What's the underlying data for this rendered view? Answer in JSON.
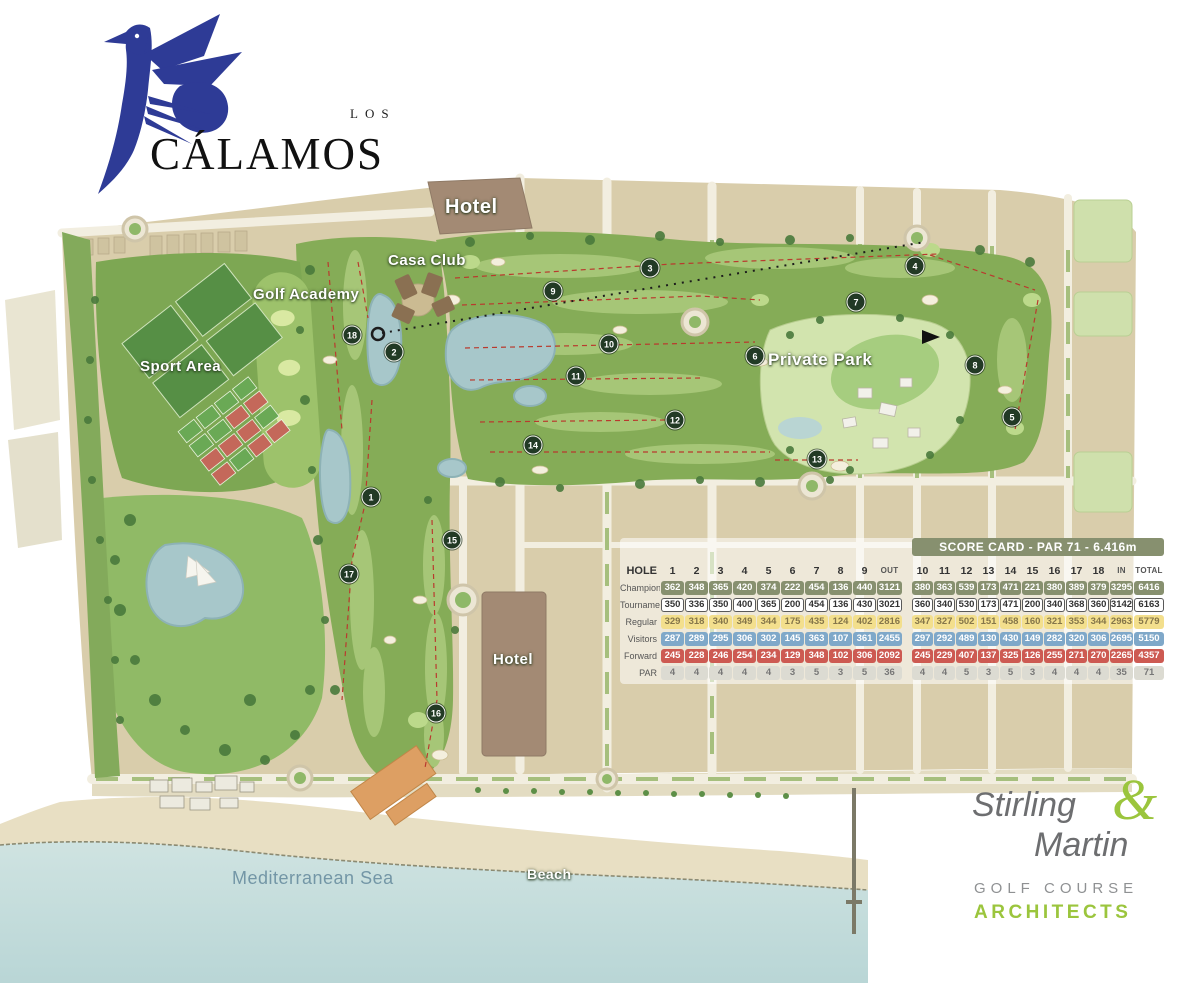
{
  "logo": {
    "pretitle": "LOS",
    "title": "CÁLAMOS"
  },
  "map": {
    "labels": {
      "hotel_north": "Hotel",
      "casa_club": "Casa Club",
      "golf_academy": "Golf Academy",
      "sport_area": "Sport Area",
      "private_park": "Private Park",
      "hotel_beach": "Hotel",
      "beach": "Beach",
      "sea": "Mediterranean Sea"
    },
    "holes": [
      {
        "n": "1",
        "x": 371,
        "y": 497
      },
      {
        "n": "2",
        "x": 394,
        "y": 352
      },
      {
        "n": "3",
        "x": 650,
        "y": 268
      },
      {
        "n": "4",
        "x": 915,
        "y": 266
      },
      {
        "n": "5",
        "x": 1012,
        "y": 417
      },
      {
        "n": "6",
        "x": 755,
        "y": 356
      },
      {
        "n": "7",
        "x": 856,
        "y": 302
      },
      {
        "n": "8",
        "x": 975,
        "y": 365
      },
      {
        "n": "9",
        "x": 553,
        "y": 291
      },
      {
        "n": "10",
        "x": 609,
        "y": 344
      },
      {
        "n": "11",
        "x": 576,
        "y": 376
      },
      {
        "n": "12",
        "x": 675,
        "y": 420
      },
      {
        "n": "13",
        "x": 817,
        "y": 459
      },
      {
        "n": "14",
        "x": 533,
        "y": 445
      },
      {
        "n": "15",
        "x": 452,
        "y": 540
      },
      {
        "n": "16",
        "x": 436,
        "y": 713
      },
      {
        "n": "17",
        "x": 349,
        "y": 574
      },
      {
        "n": "18",
        "x": 352,
        "y": 335
      }
    ]
  },
  "scorecard": {
    "title": "SCORE CARD - PAR 71 - 6.416m",
    "hole_header": "HOLE",
    "out_label": "OUT",
    "in_label": "IN",
    "total_label": "TOTAL",
    "front_holes": [
      "1",
      "2",
      "3",
      "4",
      "5",
      "6",
      "7",
      "8",
      "9"
    ],
    "back_holes": [
      "10",
      "11",
      "12",
      "13",
      "14",
      "15",
      "16",
      "17",
      "18"
    ],
    "rows": [
      {
        "label": "Champions",
        "style": "champions",
        "front": [
          362,
          348,
          365,
          420,
          374,
          222,
          454,
          136,
          440
        ],
        "out": 3121,
        "back": [
          380,
          363,
          539,
          173,
          471,
          221,
          380,
          389,
          379
        ],
        "in": 3295,
        "total": 6416
      },
      {
        "label": "Tournament",
        "style": "tournament",
        "front": [
          350,
          336,
          350,
          400,
          365,
          200,
          454,
          136,
          430
        ],
        "out": 3021,
        "back": [
          360,
          340,
          530,
          173,
          471,
          200,
          340,
          368,
          360
        ],
        "in": 3142,
        "total": 6163
      },
      {
        "label": "Regular",
        "style": "regular",
        "front": [
          329,
          318,
          340,
          349,
          344,
          175,
          435,
          124,
          402
        ],
        "out": 2816,
        "back": [
          347,
          327,
          502,
          151,
          458,
          160,
          321,
          353,
          344
        ],
        "in": 2963,
        "total": 5779
      },
      {
        "label": "Visitors",
        "style": "visitors",
        "front": [
          287,
          289,
          295,
          306,
          302,
          145,
          363,
          107,
          361
        ],
        "out": 2455,
        "back": [
          297,
          292,
          489,
          130,
          430,
          149,
          282,
          320,
          306
        ],
        "in": 2695,
        "total": 5150
      },
      {
        "label": "Forward",
        "style": "forward",
        "front": [
          245,
          228,
          246,
          254,
          234,
          129,
          348,
          102,
          306
        ],
        "out": 2092,
        "back": [
          245,
          229,
          407,
          137,
          325,
          126,
          255,
          271,
          270
        ],
        "in": 2265,
        "total": 4357
      },
      {
        "label": "PAR",
        "style": "par",
        "front": [
          4,
          4,
          4,
          4,
          4,
          3,
          5,
          3,
          5
        ],
        "out": 36,
        "back": [
          4,
          4,
          5,
          3,
          5,
          3,
          4,
          4,
          4
        ],
        "in": 35,
        "total": 71
      }
    ]
  },
  "architects": {
    "name1": "Stirling",
    "amp": "&",
    "name2": "Martin",
    "sub1": "GOLF COURSE",
    "sub2": "ARCHITECTS"
  },
  "colors": {
    "logo_navy": "#2e3b96",
    "architect_green": "#9bc53d",
    "scorecard_olive": "#87906f",
    "visitors_blue": "#7fa8c9",
    "forward_red": "#cd5a52",
    "regular_yellow": "#f3df8d",
    "sea": "#c5dddd",
    "land": "#d9cdab",
    "fairway": "#85ac57"
  }
}
